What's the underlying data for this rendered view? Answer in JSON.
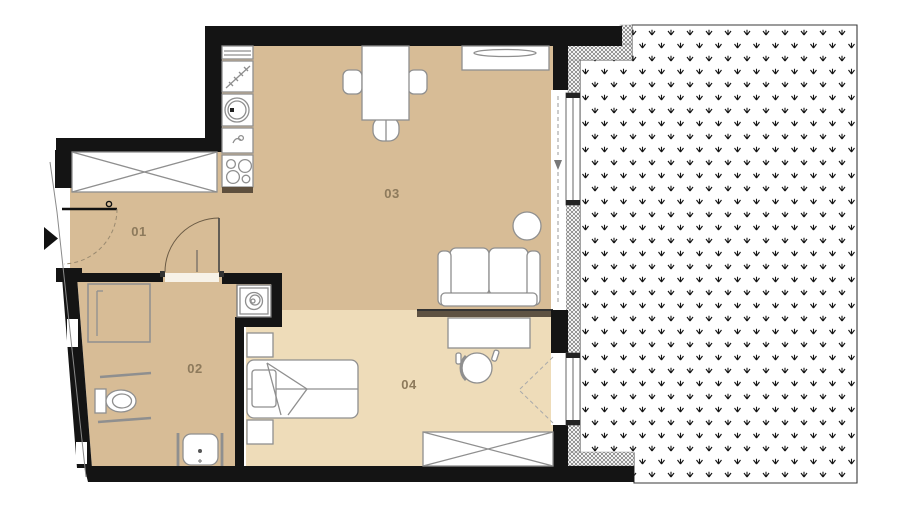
{
  "rooms": [
    {
      "number": "01"
    },
    {
      "number": "02"
    },
    {
      "number": "03"
    },
    {
      "number": "04"
    }
  ],
  "colors": {
    "floor_rooms_01_02_03": "#d7bc96",
    "floor_room_04": "#eedcb9",
    "walls": "#141414",
    "room_label_text": "#8d7a5c",
    "furniture_outline": "#8f8f8f",
    "room_divider": "#5e5242",
    "kitchen_counter_edge": "#5e4f3d",
    "terrace_dot_pattern": "#141414",
    "door_swing_line": "#999999"
  }
}
